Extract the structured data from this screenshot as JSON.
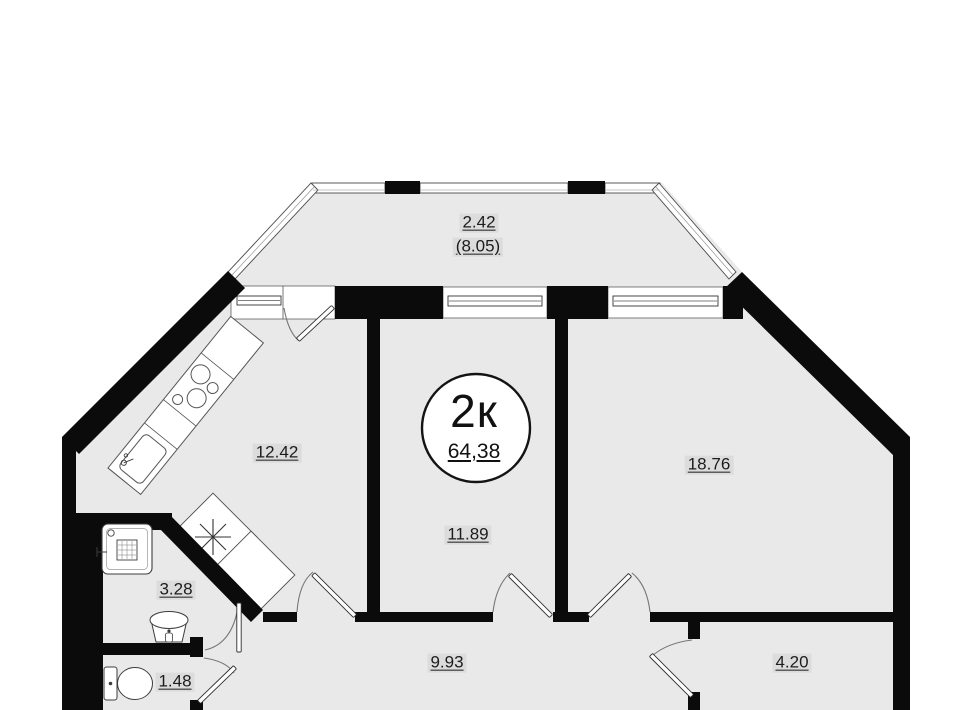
{
  "plan": {
    "badge": {
      "rooms_label": "2к",
      "total_area": "64,38"
    },
    "rooms": {
      "balcony": {
        "area": "2.42",
        "area_total": "(8.05)"
      },
      "kitchen": {
        "area": "12.42"
      },
      "room_mid": {
        "area": "11.89"
      },
      "room_right": {
        "area": "18.76"
      },
      "hallway": {
        "area": "9.93"
      },
      "bathroom": {
        "area": "3.28"
      },
      "wc": {
        "area": "1.48"
      },
      "storage": {
        "area": "4.20"
      }
    },
    "colors": {
      "walls": "#0b0b0b",
      "floor": "#e9e9e9",
      "label_background": "#dcdcdc",
      "fixture_outline": "#3d3d3d",
      "glazing_outline": "#4a4a4a"
    },
    "icons": {
      "stove-icon": "four burner circles",
      "kitchen-sink-icon": "rounded basin with faucet",
      "shower-icon": "square tray with drain grid",
      "washbasin-icon": "pedestal sink with tap",
      "toilet-icon": "tank and bowl",
      "vent-shaft-icon": "asterisk in rotated square",
      "door-icon": "leaf with swing arc",
      "window-icon": "double-line sill"
    }
  }
}
